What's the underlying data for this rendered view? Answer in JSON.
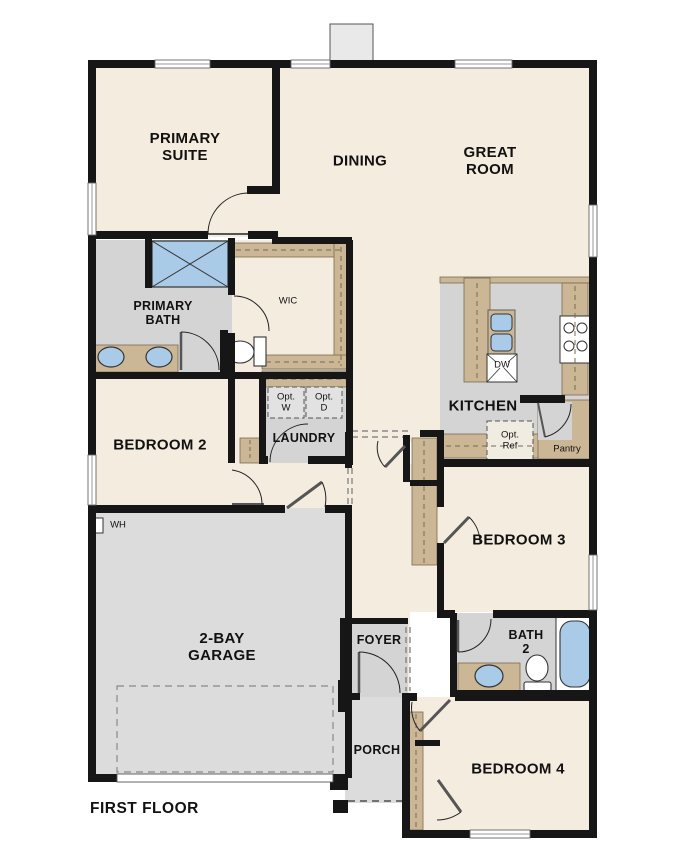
{
  "floor_plan": {
    "title": "FIRST FLOOR",
    "rooms": {
      "primary_suite": "PRIMARY\nSUITE",
      "dining": "DINING",
      "great_room": "GREAT\nROOM",
      "primary_bath": "PRIMARY\nBATH",
      "wic": "WIC",
      "laundry": "LAUNDRY",
      "bedroom_2": "BEDROOM 2",
      "kitchen": "KITCHEN",
      "pantry": "Pantry",
      "bedroom_3": "BEDROOM 3",
      "garage": "2-BAY\nGARAGE",
      "foyer": "FOYER",
      "bath_2": "BATH\n2",
      "bedroom_4": "BEDROOM 4",
      "porch": "PORCH"
    },
    "fixtures": {
      "opt_washer": "Opt.\nW",
      "opt_dryer": "Opt.\nD",
      "opt_refrigerator": "Opt.\nRef",
      "dishwasher": "DW",
      "water_heater": "WH"
    },
    "colors": {
      "wall": "#161616",
      "room_cream": "#f4ecdf",
      "wet_area_gray": "#d4d4d4",
      "garage_gray": "#dcdcdc",
      "cabinet_tan": "#cbb795",
      "fixture_blue": "#a9cbe7",
      "chimney_gray": "#e9e9e9"
    }
  }
}
